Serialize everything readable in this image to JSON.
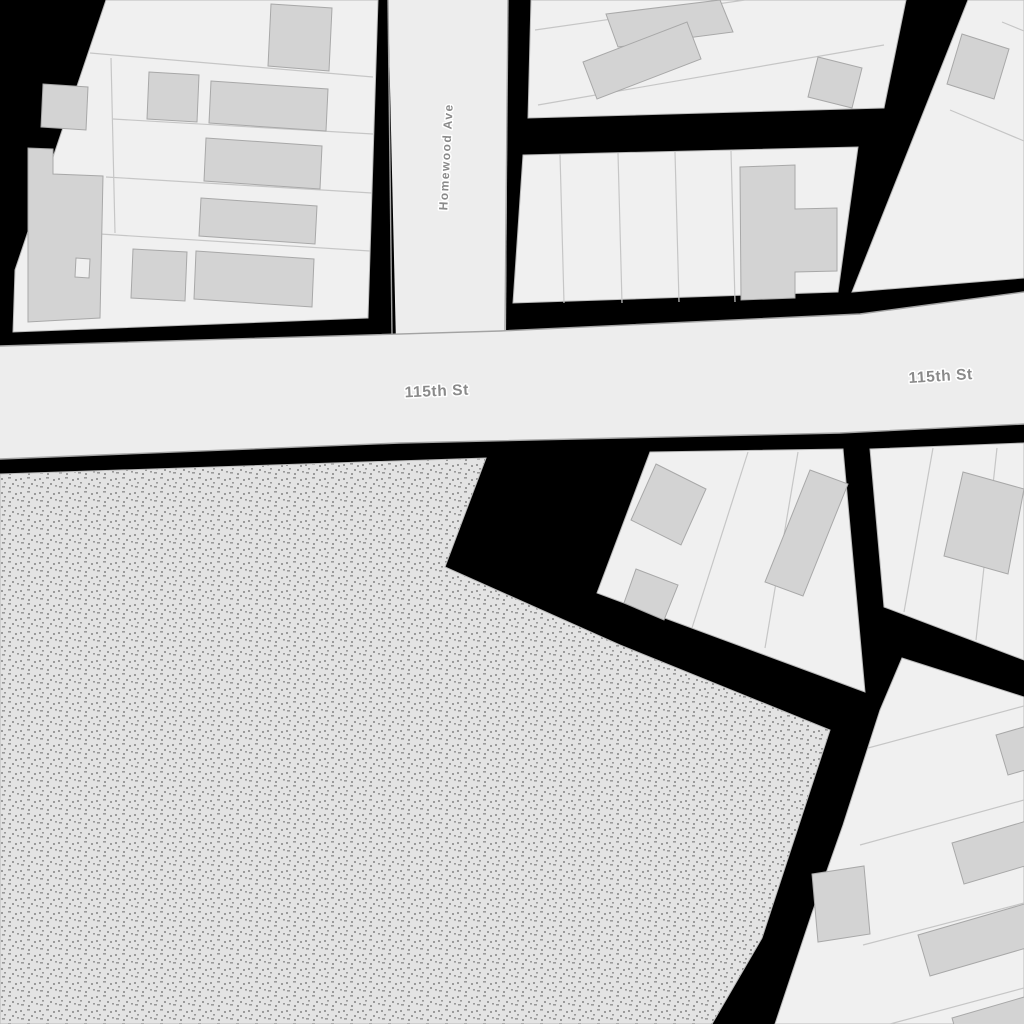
{
  "map": {
    "labels": {
      "homewood_ave": "Homewood Ave",
      "street_115_west": "115th St",
      "street_115_east": "115th St"
    },
    "colors": {
      "background": "#000000",
      "road_fill": "#ededed",
      "road_casing": "#a3a3a3",
      "block_fill": "#f0f0f0",
      "block_stroke": "#bababa",
      "parcel_line": "#c6c6c6",
      "building_fill": "#d3d3d3",
      "building_stroke": "#a8a8a8",
      "landuse_fill": "#e3e3e3",
      "landuse_dot": "#9a9a9a",
      "label_color": "#8a8a8a",
      "label_halo": "#ffffff"
    },
    "textures": {
      "landuse": "stippled-dots"
    }
  }
}
